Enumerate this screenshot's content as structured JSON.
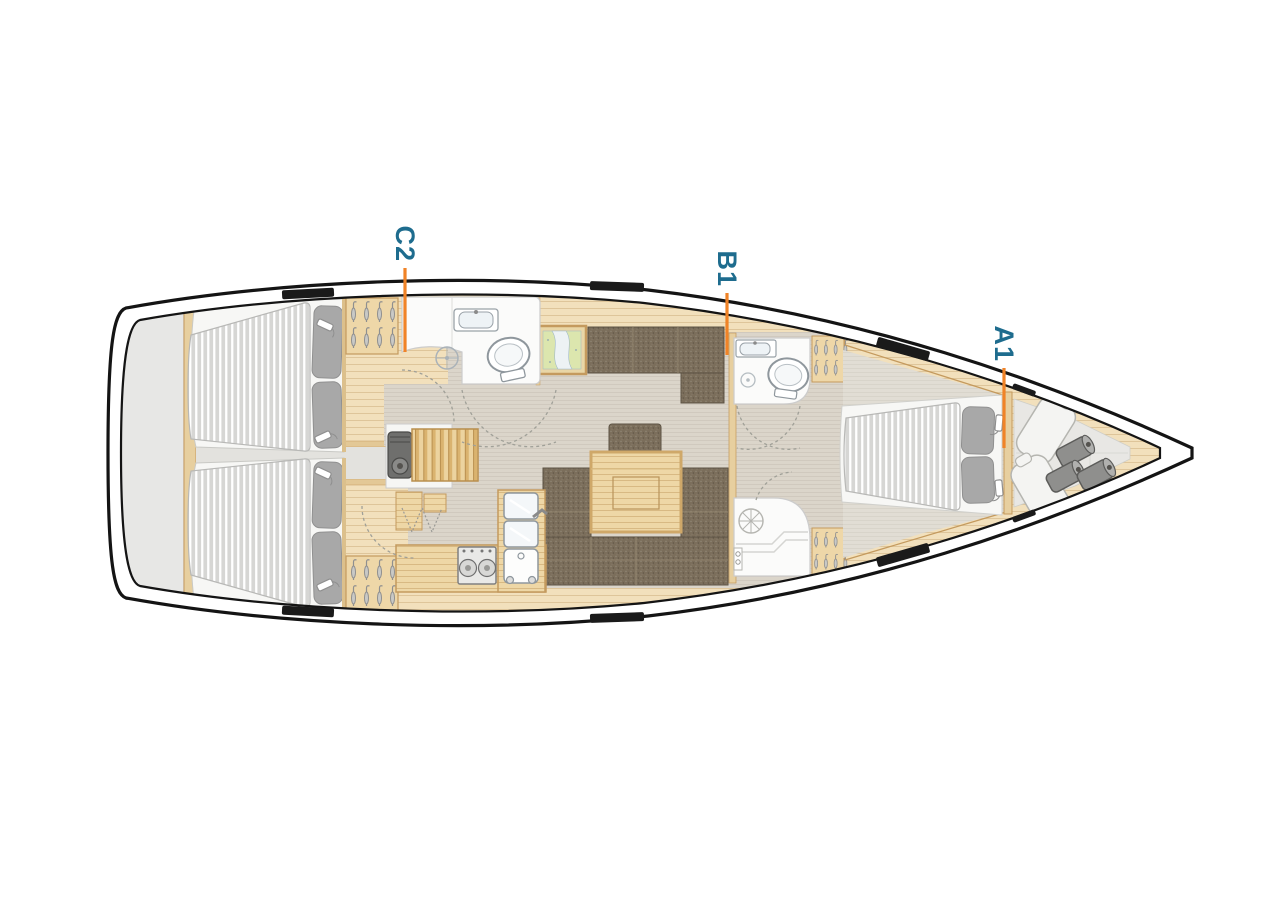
{
  "page": {
    "background": "#FFFFFF"
  },
  "plan": {
    "type": "sailing-yacht-interior-layout-top-view",
    "labels": [
      {
        "id": "C2",
        "text": "C2"
      },
      {
        "id": "B1",
        "text": "B1"
      },
      {
        "id": "A1",
        "text": "A1"
      }
    ],
    "colors": {
      "label_text": "#1E6C8E",
      "leader_line": "#F08327",
      "hull_line": "#141414",
      "wood_light": "#F2E0BC",
      "wood_trim": "#C49A5E",
      "floor_gray": "#DBD5CA",
      "upholstery": "#7B6E5B",
      "mattress": "#D7D7D5",
      "pillow": "#A8A8A8",
      "fixture_white": "#FBFBFA"
    },
    "areas": [
      "aft-cabin-port",
      "aft-cabin-starboard",
      "engine-compartment",
      "companionway-steps",
      "galley",
      "saloon",
      "nav-chart-table",
      "head-aft",
      "head-forward",
      "shower-room",
      "owners-cabin-forward",
      "sail-locker-bow"
    ]
  }
}
